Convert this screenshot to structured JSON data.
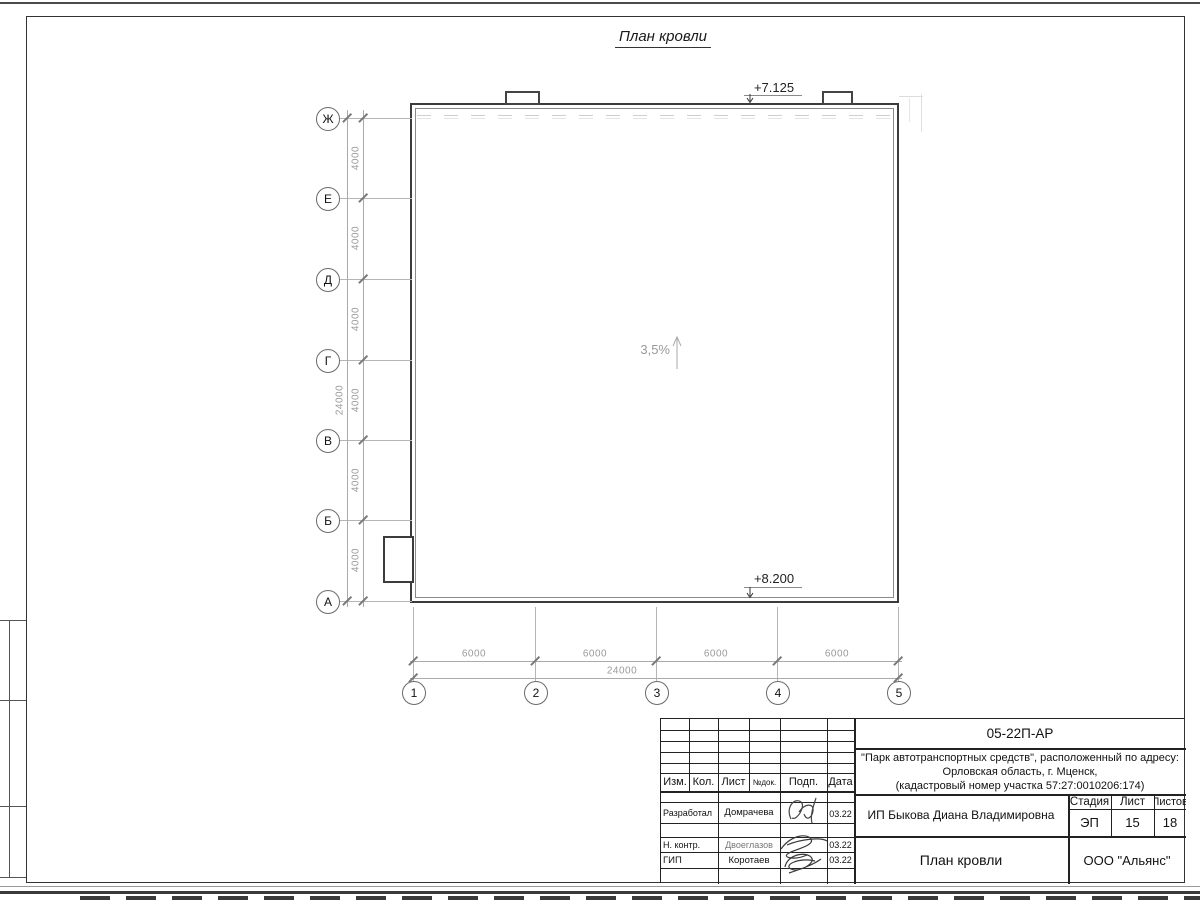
{
  "page": {
    "title": "План кровли"
  },
  "drawing": {
    "slope_label": "3,5%",
    "elevation_top": "+7.125",
    "elevation_bottom": "+8.200",
    "left_axes": [
      "Ж",
      "Е",
      "Д",
      "Г",
      "В",
      "Б",
      "А"
    ],
    "bottom_axes": [
      "1",
      "2",
      "3",
      "4",
      "5"
    ],
    "dims_left": [
      "4000",
      "4000",
      "4000",
      "4000",
      "4000",
      "4000"
    ],
    "dim_left_total": "24000",
    "dims_bottom": [
      "6000",
      "6000",
      "6000",
      "6000"
    ],
    "dim_bottom_total": "24000"
  },
  "titleblock": {
    "doc_number": "05-22П-АР",
    "project_line1": "\"Парк автотранспортных средств\",  расположенный по адресу:",
    "project_line2": "Орловская область, г. Мценск,",
    "project_line3": "(кадастровый номер участка 57:27:0010206:174)",
    "client": "ИП Быкова Диана Владимировна",
    "sheet_title": "План кровли",
    "company": "ООО \"Альянс\"",
    "cols": {
      "izm": "Изм.",
      "kol": "Кол.",
      "list": "Лист",
      "ndok": "№док.",
      "podp": "Подп.",
      "data": "Дата"
    },
    "stage_label": "Стадия",
    "sheet_label": "Лист",
    "sheets_label": "Листов",
    "stage": "ЭП",
    "sheet": "15",
    "sheets": "18",
    "rows": [
      {
        "role": "Разработал",
        "name": "Домрачева",
        "date": "03.22"
      },
      {
        "role": "Н. контр.",
        "name": "Двоеглазов",
        "date": "03.22"
      },
      {
        "role": "ГИП",
        "name": "Коротаев",
        "date": "03.22"
      }
    ]
  },
  "colors": {
    "line_dark": "#3c3c3c",
    "line_dim": "#aaaaaa",
    "text_dim": "#9a9a9a"
  }
}
